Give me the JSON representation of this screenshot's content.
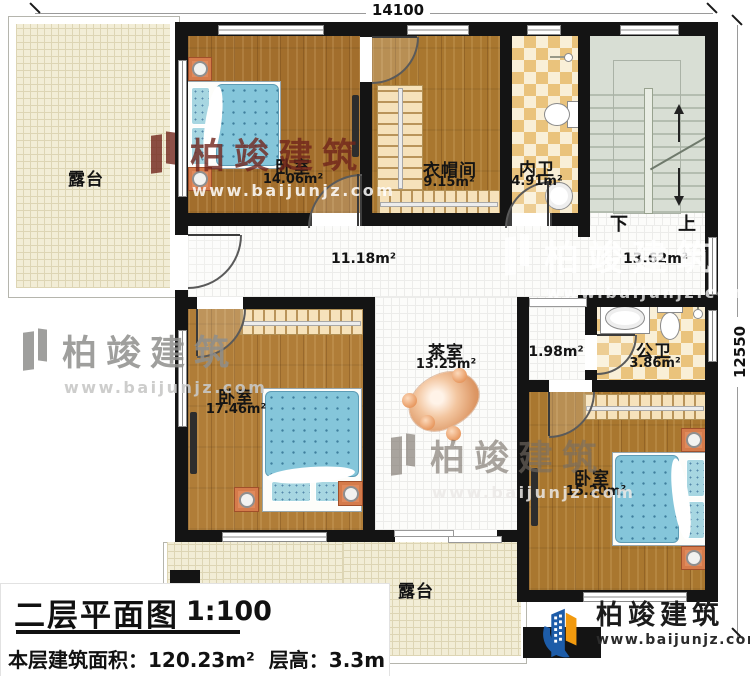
{
  "dims": {
    "width": "14100",
    "height": "12550"
  },
  "rooms": {
    "terrace_left": {
      "name": "露台"
    },
    "bedroom1": {
      "name": "卧室",
      "area": "14.06m²"
    },
    "cloakroom": {
      "name": "衣帽间",
      "area": "9.15m²"
    },
    "inner_bath": {
      "name": "内卫",
      "area": "4.91m²"
    },
    "corridor": {
      "area": "11.18m²"
    },
    "hall": {
      "area": "13.62m²"
    },
    "bedroom2": {
      "name": "卧室",
      "area": "17.46m²"
    },
    "tea_room": {
      "name": "茶室",
      "area": "13.25m²"
    },
    "vestibule": {
      "area": "1.98m²"
    },
    "public_bath": {
      "name": "公卫",
      "area": "3.86m²"
    },
    "bedroom3": {
      "name": "卧室",
      "area": "15.20m²"
    },
    "terrace_bottom": {
      "name": "露台"
    }
  },
  "stairs": {
    "down": "下",
    "up": "上"
  },
  "title_block": {
    "title": "二层平面图",
    "scale": "1:100",
    "area_line": "本层建筑面积：120.23m²",
    "height_line": "层高：3.3m"
  },
  "brand": {
    "name": "柏竣建筑",
    "url": "www.baijunjz.com"
  },
  "watermark": {
    "name": "柏竣建筑",
    "url": "www.baijunjz.com"
  },
  "colors": {
    "wall": "#141414",
    "wood": "#a9772f",
    "tile": "#eac37c",
    "stairs": "#d8ded4",
    "terrace": "#f2edd6",
    "brand_blue": "#1d5ca8",
    "brand_orange": "#f29a0e",
    "bed_blue": "#85c6da",
    "furniture_orange": "#e08a5c"
  }
}
